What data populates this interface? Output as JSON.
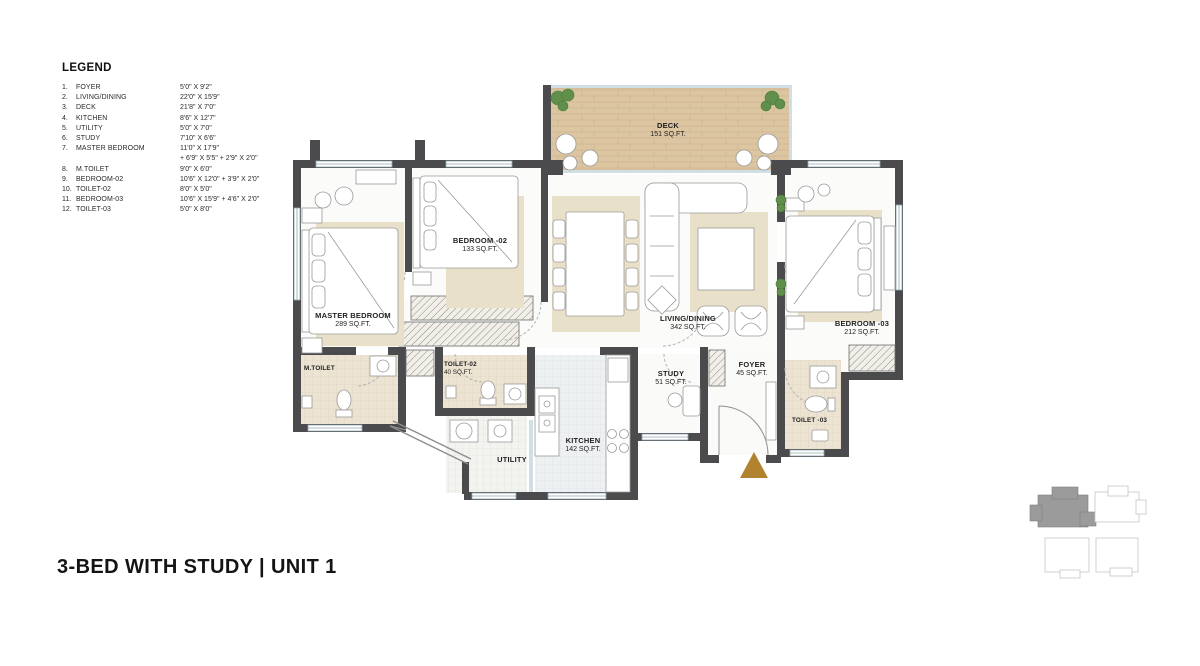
{
  "page": {
    "title": "3-BED WITH STUDY | UNIT 1"
  },
  "legend": {
    "heading": "LEGEND",
    "items": [
      {
        "num": "1.",
        "name": "FOYER",
        "dim": "5'0\" X 9'2\""
      },
      {
        "num": "2.",
        "name": "LIVING/DINING",
        "dim": "22'0\" X 15'9\""
      },
      {
        "num": "3.",
        "name": "DECK",
        "dim": "21'8\" X 7'0\""
      },
      {
        "num": "4.",
        "name": "KITCHEN",
        "dim": "8'6\" X 12'7\""
      },
      {
        "num": "5.",
        "name": "UTILITY",
        "dim": "5'0\" X 7'0\""
      },
      {
        "num": "6.",
        "name": "STUDY",
        "dim": "7'10\" X 6'6\""
      },
      {
        "num": "7.",
        "name": "MASTER BEDROOM",
        "dim": "11'0\" X 17'9\"",
        "dim2": "+ 6'9\" X 5'5\" + 2'9\" X 2'0\""
      },
      {
        "num": "8.",
        "name": "M.TOILET",
        "dim": "9'0\" X 6'0\""
      },
      {
        "num": "9.",
        "name": "BEDROOM-02",
        "dim": "10'6\" X 12'0\" + 3'9\" X 2'0\""
      },
      {
        "num": "10.",
        "name": "TOILET-02",
        "dim": "8'0\" X 5'0\""
      },
      {
        "num": "11.",
        "name": "BEDROOM-03",
        "dim": "10'6\" X 15'9\" + 4'6\" X 2'0\""
      },
      {
        "num": "12.",
        "name": "TOILET-03",
        "dim": "5'0\" X 8'0\""
      }
    ]
  },
  "rooms": {
    "deck": {
      "name": "DECK",
      "area": "151 SQ.FT."
    },
    "master_bedroom": {
      "name": "MASTER BEDROOM",
      "area": "289 SQ.FT."
    },
    "bedroom_02": {
      "name": "BEDROOM -02",
      "area": "133 SQ.FT."
    },
    "bedroom_03": {
      "name": "BEDROOM -03",
      "area": "212 SQ.FT."
    },
    "living_dining": {
      "name": "LIVING/DINING",
      "area": "342 SQ.FT."
    },
    "m_toilet": {
      "name": "M.TOILET"
    },
    "toilet_02": {
      "name": "TOILET-02",
      "area": "40 SQ.FT."
    },
    "toilet_03": {
      "name": "TOILET -03"
    },
    "kitchen": {
      "name": "KITCHEN",
      "area": "142 SQ.FT."
    },
    "utility": {
      "name": "UTILITY"
    },
    "study": {
      "name": "STUDY",
      "area": "51 SQ.FT."
    },
    "foyer": {
      "name": "FOYER",
      "area": "45 SQ.FT."
    }
  },
  "colors": {
    "wall": "#4b4b4d",
    "deck_wood": "#dcc6a2",
    "rug_beige": "#e9e0ca",
    "toilet_floor": "#ece3d2",
    "kitchen_tile": "#eef1f2",
    "glass": "#cfdfe3",
    "plant_green": "#5f8f4b",
    "entry_arrow": "#b2832f",
    "keyplan_highlight": "#9b9b9b"
  }
}
